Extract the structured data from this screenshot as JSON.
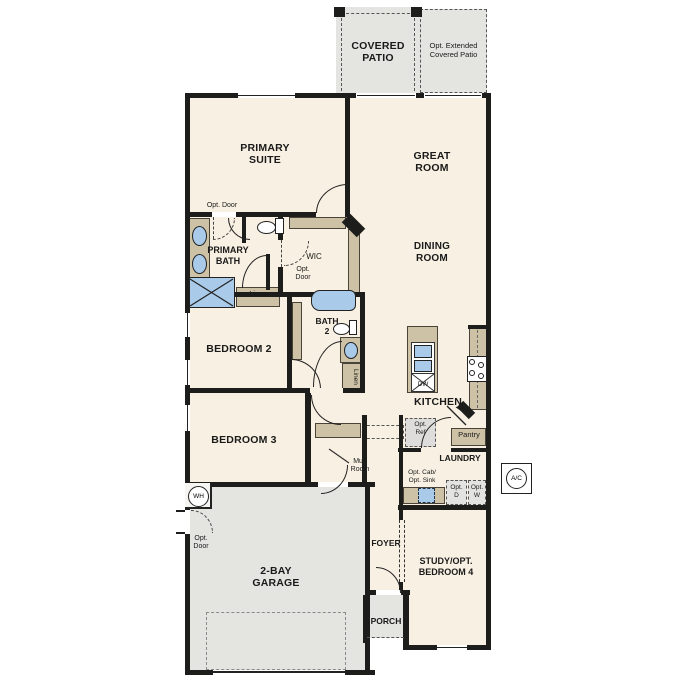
{
  "colors": {
    "cream": "#f8f0e2",
    "gray": "#e4e4e1",
    "tan": "#cdc1a6",
    "blue": "#a9cae9",
    "wall": "#1d1d1b",
    "text": "#1a1a1a"
  },
  "labels": {
    "covered_patio": "COVERED\nPATIO",
    "ext_patio": "Opt. Extended\nCovered Patio",
    "primary_suite": "PRIMARY\nSUITE",
    "great_room": "GREAT\nROOM",
    "dining_room": "DINING\nROOM",
    "primary_bath": "PRIMARY\nBATH",
    "wic": "WIC",
    "bath2": "BATH\n2",
    "bedroom2": "BEDROOM 2",
    "bedroom3": "BEDROOM 3",
    "kitchen": "KITCHEN",
    "laundry": "LAUNDRY",
    "mud_room": "Mud\nRoom",
    "pantry": "Pantry",
    "foyer": "FOYER",
    "porch": "PORCH",
    "garage": "2-BAY\nGARAGE",
    "study": "STUDY/OPT.\nBEDROOM 4",
    "linen": "Linen",
    "opt_door": "Opt. Door",
    "opt_door_stacked": "Opt.\nDoor",
    "opt_ref": "Opt.\nRef",
    "opt_cab_sink": "Opt. Cab/\nOpt. Sink",
    "opt_d": "Opt.\nD",
    "opt_w": "Opt.\nW",
    "dw": "DW",
    "wh": "WH",
    "ac": "A/C"
  }
}
